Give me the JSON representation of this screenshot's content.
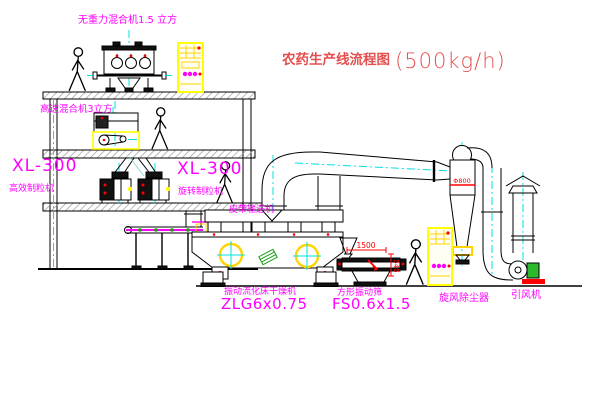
{
  "title": {
    "text": "农药生产线流程图",
    "capacity": "(500kg/h)"
  },
  "equipment": {
    "zero_gravity_mixer": "无重力混合机1.5 立方",
    "high_speed_mixer": "高速混合机3立方",
    "granulator_left": {
      "model": "XL-300",
      "name": "高效制粒机"
    },
    "granulator_mid": {
      "model": "XL-300",
      "name": "旋转制粒机"
    },
    "belt_conveyor": "皮带输送机",
    "fluid_bed_dryer": {
      "name": "振动流化床干燥机",
      "model": "ZLG6x0.75"
    },
    "square_sieve": {
      "name": "方形振动筛",
      "model": "FS0.6x1.5"
    },
    "cyclone": "旋风除尘器",
    "induced_draft_fan": "引风机"
  },
  "dimensions": {
    "sieve_length": "1500",
    "sieve_height": "545",
    "cyclone_dia": "Φ800"
  },
  "colors": {
    "label_magenta": "#ff00ff",
    "title_red": "#e34f4f",
    "centerline_cyan": "#00e0e0",
    "highlight_yellow": "#ffff00",
    "accent_green": "#18a018",
    "dimension_red": "#ff0000",
    "line_black": "#000000"
  }
}
